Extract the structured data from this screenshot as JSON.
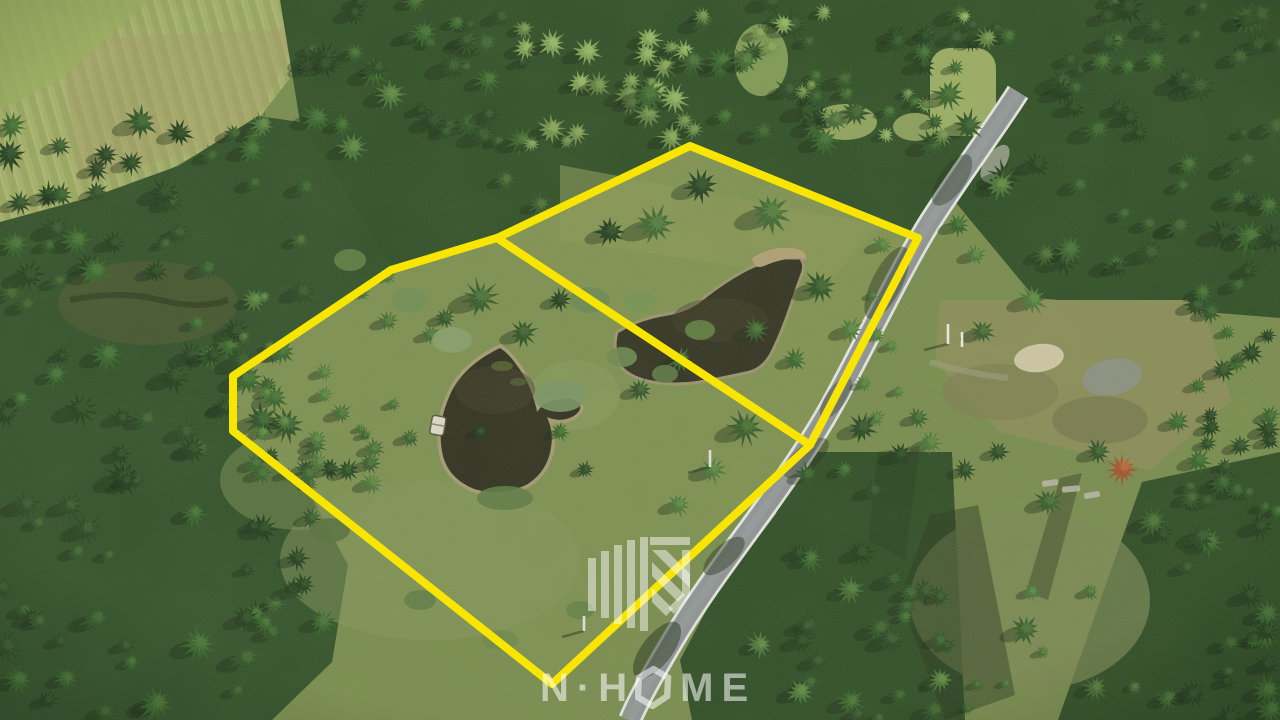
{
  "watermark": {
    "brand": "N·HOME",
    "letters": {
      "n": "N",
      "dot": "·",
      "h": "H",
      "o": "O",
      "m": "M",
      "e": "E"
    },
    "color": "rgba(255,255,255,0.55)"
  },
  "boundary": {
    "color": "#f8e602",
    "stroke_width": 8,
    "parcels": [
      {
        "id": "parcel-left",
        "points": "497,238 391,270 233,376 233,431 552,684 810,445"
      },
      {
        "id": "parcel-right",
        "points": "497,238 690,146 918,238 810,445"
      }
    ]
  }
}
